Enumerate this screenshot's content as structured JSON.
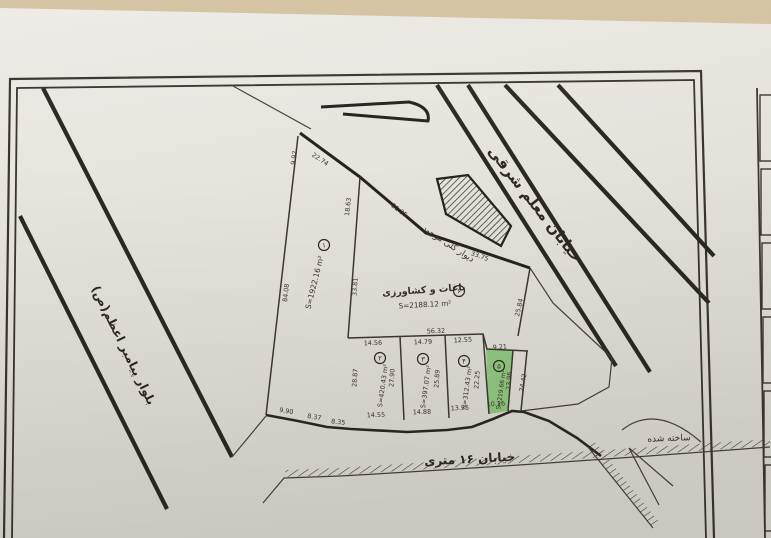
{
  "colors": {
    "table_bg": "#cdbb97",
    "paper": "#e6e3dc",
    "ink": "#38332a",
    "highlight_green": "#7cc06a"
  },
  "labels": {
    "street_top": "خیابان معلم شرقی",
    "street_left": "بلوار پیامبر اعظم(ص)",
    "street_bottom": "خیابان ۱۶ متری",
    "note_wall": "دیوار گلی موجود",
    "note_built": "ساخته شده",
    "parcel6_use": "باغات و کشاورزی"
  },
  "parcels": [
    {
      "no": "۱",
      "area": "S=1922.16 m²",
      "marker": {
        "x": 324,
        "y": 245
      },
      "area_pos": {
        "x": 317,
        "y": 283,
        "r": -76,
        "size": 7.5
      }
    },
    {
      "no": "۲",
      "area": "S=420.43 m²",
      "marker": {
        "x": 380,
        "y": 358
      },
      "area_pos": {
        "x": 385,
        "y": 386,
        "r": -82,
        "size": 6.5
      }
    },
    {
      "no": "۳",
      "area": "S=397.07 m²",
      "marker": {
        "x": 423,
        "y": 359
      },
      "area_pos": {
        "x": 428,
        "y": 387,
        "r": -82,
        "size": 6.5
      }
    },
    {
      "no": "۴",
      "area": "S=312.43 m²",
      "marker": {
        "x": 464,
        "y": 361
      },
      "area_pos": {
        "x": 469,
        "y": 388,
        "r": -82,
        "size": 6.5
      }
    },
    {
      "no": "۵",
      "area": "S=219.66 m²",
      "marker": {
        "x": 499,
        "y": 366
      },
      "area_pos": {
        "x": 503,
        "y": 390,
        "r": -82,
        "size": 6
      }
    },
    {
      "no": "۶",
      "area": "S=2188.12 m²",
      "marker": {
        "x": 459,
        "y": 291
      },
      "area_pos": {
        "x": 425,
        "y": 307,
        "r": -3,
        "size": 7.2
      }
    }
  ],
  "measurements": [
    {
      "t": "9.92",
      "x": 296,
      "y": 158,
      "r": -83
    },
    {
      "t": "22.74",
      "x": 319,
      "y": 161,
      "r": 34
    },
    {
      "t": "18.63",
      "x": 350,
      "y": 207,
      "r": -84
    },
    {
      "t": "21.35",
      "x": 398,
      "y": 212,
      "r": 37
    },
    {
      "t": "33.75",
      "x": 479,
      "y": 258,
      "r": 20
    },
    {
      "t": "84.08",
      "x": 288,
      "y": 293,
      "r": -84
    },
    {
      "t": "33.81",
      "x": 357,
      "y": 287,
      "r": -86
    },
    {
      "t": "25.84",
      "x": 521,
      "y": 308,
      "r": -77
    },
    {
      "t": "56.32",
      "x": 436,
      "y": 333,
      "r": -2
    },
    {
      "t": "14.56",
      "x": 373,
      "y": 345,
      "r": -2
    },
    {
      "t": "14.79",
      "x": 423,
      "y": 344,
      "r": -2
    },
    {
      "t": "12.55",
      "x": 463,
      "y": 342,
      "r": -3
    },
    {
      "t": "9.21",
      "x": 500,
      "y": 349,
      "r": -4
    },
    {
      "t": "28.87",
      "x": 357,
      "y": 378,
      "r": -86
    },
    {
      "t": "27.90",
      "x": 394,
      "y": 378,
      "r": -86
    },
    {
      "t": "25.89",
      "x": 439,
      "y": 379,
      "r": -86
    },
    {
      "t": "22.25",
      "x": 479,
      "y": 380,
      "r": -86
    },
    {
      "t": "23.96",
      "x": 511,
      "y": 381,
      "r": -86
    },
    {
      "t": "24.42",
      "x": 525,
      "y": 383,
      "r": -80
    },
    {
      "t": "9.90",
      "x": 286,
      "y": 413,
      "r": 9
    },
    {
      "t": "8.37",
      "x": 314,
      "y": 419,
      "r": 9
    },
    {
      "t": "8.35",
      "x": 338,
      "y": 424,
      "r": 6
    },
    {
      "t": "14.55",
      "x": 376,
      "y": 417,
      "r": -2
    },
    {
      "t": "14.88",
      "x": 422,
      "y": 414,
      "r": -2
    },
    {
      "t": "13.35",
      "x": 460,
      "y": 410,
      "r": -3
    },
    {
      "t": "10.26",
      "x": 496,
      "y": 406,
      "r": -3
    }
  ]
}
